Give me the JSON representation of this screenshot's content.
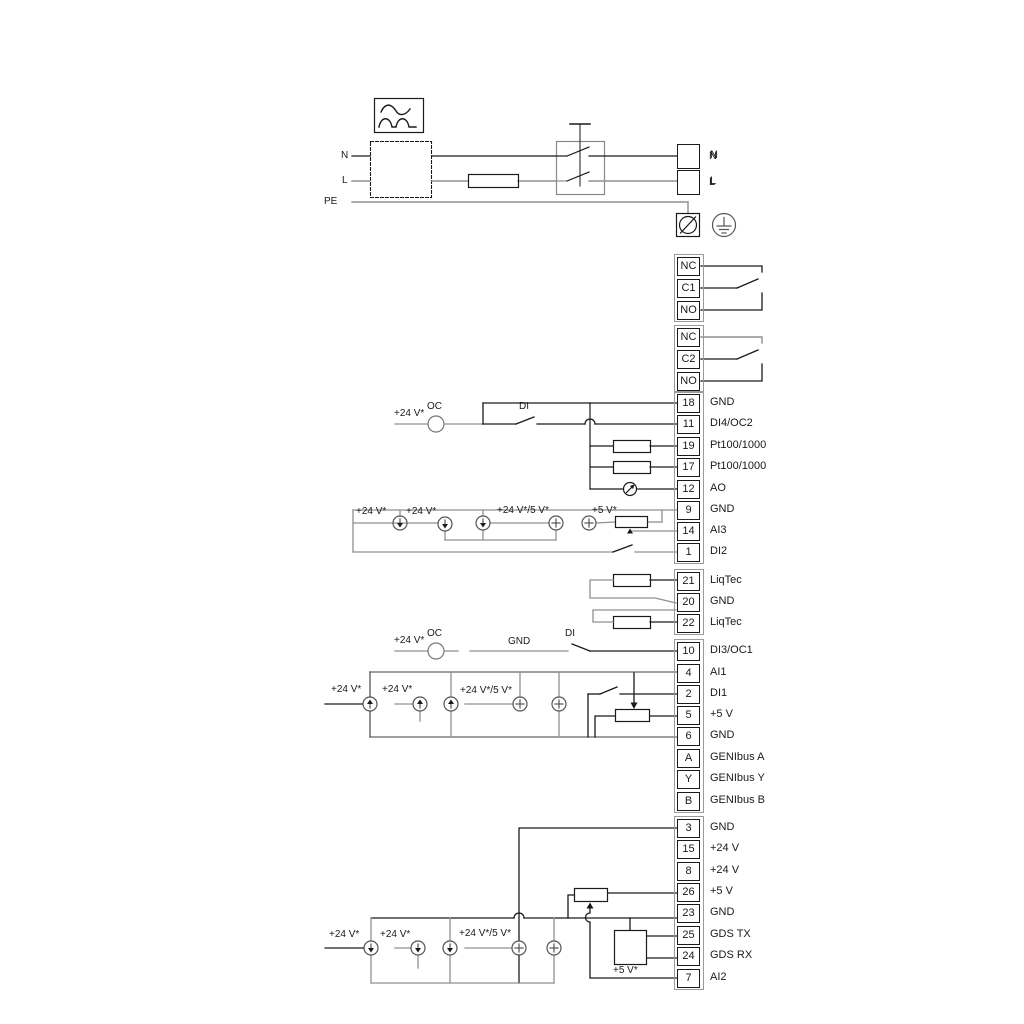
{
  "diagram_title": "Pump control wiring diagram",
  "colors": {
    "wire_dark": "#1a1a1a",
    "wire_gray": "#909090",
    "terminal_border": "#1a1a1a",
    "strip_border": "#9a9a9a",
    "background": "#ffffff"
  },
  "wire_labels": [
    {
      "t": "N"
    },
    {
      "t": "L"
    },
    {
      "t": "PE"
    },
    {
      "t": "N"
    },
    {
      "t": "L"
    },
    {
      "t": "+24 V*"
    },
    {
      "t": "OC"
    },
    {
      "t": "DI"
    },
    {
      "t": "+24 V*"
    },
    {
      "t": "+24 V*"
    },
    {
      "t": "+24 V*/5 V*"
    },
    {
      "t": "+5 V*"
    },
    {
      "t": "+24 V*"
    },
    {
      "t": "OC"
    },
    {
      "t": "GND"
    },
    {
      "t": "DI"
    },
    {
      "t": "+24 V*"
    },
    {
      "t": "+24 V*"
    },
    {
      "t": "+24 V*/5 V*"
    },
    {
      "t": "+24 V*"
    },
    {
      "t": "+24 V*"
    },
    {
      "t": "+24 V*/5 V*"
    },
    {
      "t": "+5 V*"
    }
  ],
  "terminal_groups": [
    {
      "name": "mains-output",
      "cells": [
        {
          "id": "",
          "label": "N"
        },
        {
          "id": "",
          "label": "L"
        }
      ]
    },
    {
      "name": "relay-1",
      "cells": [
        {
          "id": "NC",
          "label": ""
        },
        {
          "id": "C1",
          "label": ""
        },
        {
          "id": "NO",
          "label": ""
        }
      ]
    },
    {
      "name": "relay-2",
      "cells": [
        {
          "id": "NC",
          "label": ""
        },
        {
          "id": "C2",
          "label": ""
        },
        {
          "id": "NO",
          "label": ""
        }
      ]
    },
    {
      "name": "io-block-1",
      "cells": [
        {
          "id": "18",
          "label": "GND"
        },
        {
          "id": "11",
          "label": "DI4/OC2"
        },
        {
          "id": "19",
          "label": "Pt100/1000"
        },
        {
          "id": "17",
          "label": "Pt100/1000"
        },
        {
          "id": "12",
          "label": "AO"
        },
        {
          "id": "9",
          "label": "GND"
        },
        {
          "id": "14",
          "label": "AI3"
        },
        {
          "id": "1",
          "label": "DI2"
        }
      ]
    },
    {
      "name": "liqtec-block",
      "cells": [
        {
          "id": "21",
          "label": "LiqTec"
        },
        {
          "id": "20",
          "label": "GND"
        },
        {
          "id": "22",
          "label": "LiqTec"
        }
      ]
    },
    {
      "name": "io-block-2",
      "cells": [
        {
          "id": "10",
          "label": "DI3/OC1"
        },
        {
          "id": "4",
          "label": "AI1"
        },
        {
          "id": "2",
          "label": "DI1"
        },
        {
          "id": "5",
          "label": "+5 V"
        },
        {
          "id": "6",
          "label": "GND"
        },
        {
          "id": "A",
          "label": "GENIbus A"
        },
        {
          "id": "Y",
          "label": "GENIbus Y"
        },
        {
          "id": "B",
          "label": "GENIbus B"
        }
      ]
    },
    {
      "name": "io-block-3",
      "cells": [
        {
          "id": "3",
          "label": "GND"
        },
        {
          "id": "15",
          "label": "+24 V"
        },
        {
          "id": "8",
          "label": "+24 V"
        },
        {
          "id": "26",
          "label": "+5 V"
        },
        {
          "id": "23",
          "label": "GND"
        },
        {
          "id": "25",
          "label": "GDS TX"
        },
        {
          "id": "24",
          "label": "GDS RX"
        },
        {
          "id": "7",
          "label": "AI2"
        }
      ]
    }
  ]
}
